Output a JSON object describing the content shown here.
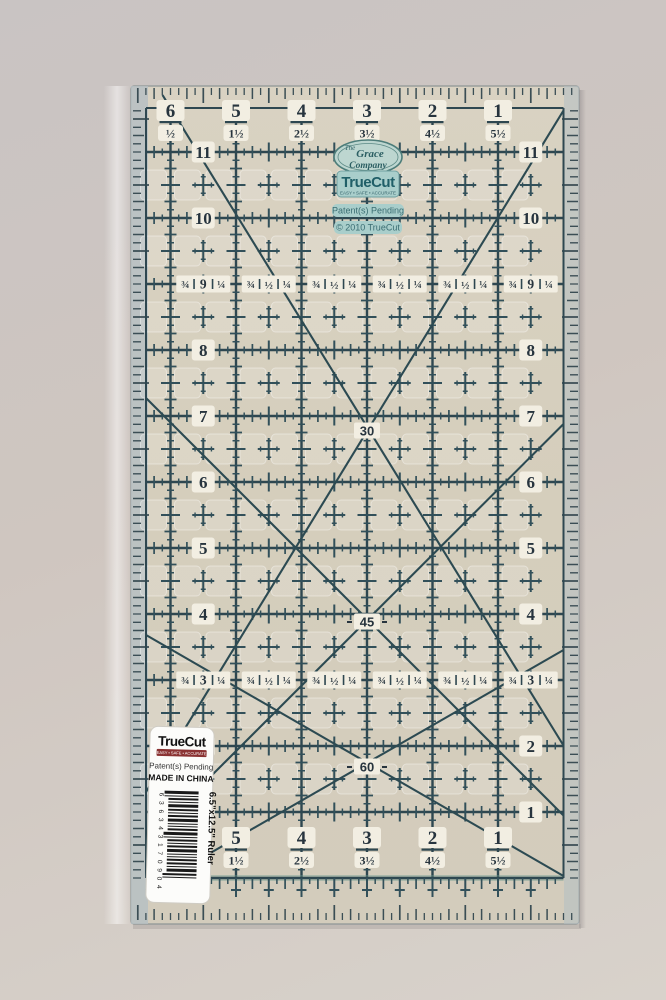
{
  "ruler": {
    "top_numbers": [
      "6",
      "5",
      "4",
      "3",
      "2",
      "1"
    ],
    "top_fractions": [
      "½",
      "1½",
      "2½",
      "3½",
      "4½",
      "5½"
    ],
    "bottom_numbers": [
      "5",
      "4",
      "3",
      "2",
      "1"
    ],
    "bottom_fractions": [
      "1½",
      "2½",
      "3½",
      "4½",
      "5½"
    ],
    "left_row_numbers": [
      "11",
      "10",
      "8",
      "7",
      "6",
      "5",
      "4",
      "2",
      "1"
    ],
    "right_row_numbers": [
      "11",
      "10",
      "8",
      "7",
      "6",
      "5",
      "4",
      "2",
      "1"
    ],
    "fraction_row_9": {
      "left": "¾",
      "right": "¼",
      "centers": [
        "9",
        "½",
        "½",
        "½",
        "½",
        "9"
      ]
    },
    "fraction_row_3": {
      "left": "¾",
      "right": "¼",
      "centers": [
        "3",
        "½",
        "½",
        "½",
        "½",
        "3"
      ]
    },
    "angle_labels": [
      "30",
      "45",
      "60"
    ],
    "brand": {
      "company_line1": "The",
      "company_line2": "Grace",
      "company_line3": "Company",
      "truecut": "TrueCut",
      "tagline": "EASY • SAFE • ACCURATE",
      "patent": "Patent(s) Pending",
      "copyright": "© 2010 TrueCut"
    }
  },
  "sticker": {
    "brand": "TrueCut",
    "tagline": "EASY • SAFE • ACCURATE",
    "patent": "Patent(s) Pending",
    "origin": "MADE IN CHINA",
    "barcode_digits": "6 36343 17090 4",
    "product": "6.5\"x12.5\" Ruler"
  },
  "colors": {
    "grid_line": "#2e4750",
    "tick": "#32505a",
    "ruler_base": "#d6cfbd",
    "edge_strip": "#b6c0c3",
    "badge_bg": "#a9cecb",
    "badge_text": "#205f68",
    "number_text": "#27343e",
    "window_bg": "#f2eee2",
    "sticker_bar": "#8a3232",
    "bottom_band": "#6f9a8e"
  }
}
